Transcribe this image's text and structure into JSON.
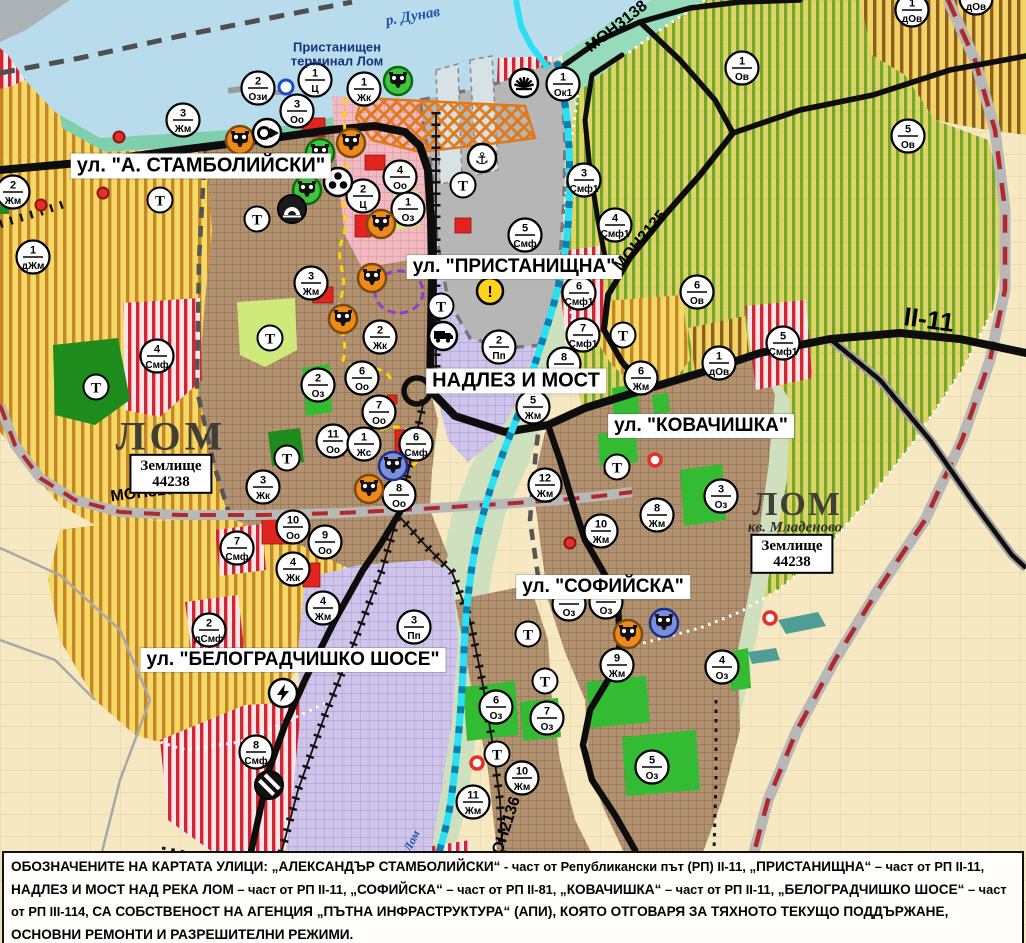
{
  "map": {
    "title": "Urban plan map of Lom (Лом), Bulgaria",
    "width": 1026,
    "height": 943
  },
  "colors": {
    "water": "#b9dcec",
    "river": "#2ae0f2",
    "river_dash": "#0b7fae",
    "shore": "#7fcfae",
    "urban": "#b29170",
    "agri": "#f5d964",
    "agri_stripe": "#c3862b",
    "olive": "#dfd468",
    "olive_stripe": "#74a82a",
    "smf_stripe": "#cf2633",
    "pink": "#f2b9c1",
    "lavender": "#cfc4e9",
    "beige": "#f6e8c1",
    "park_green": "#33bb33",
    "forest": "#1d8c1d",
    "road_black": "#0d0d0d",
    "road_red_dash": "#b02a2a",
    "label_blue": "#1f53b0",
    "port_orange": "#e0791c"
  },
  "street_labels": [
    {
      "text": "ул. \"А. СТАМБОЛИЙСКИ\"",
      "x": 201,
      "y": 166,
      "fs": 20
    },
    {
      "text": "ул. \"ПРИСТАНИЩНА\"",
      "x": 514,
      "y": 267,
      "fs": 19
    },
    {
      "text": "НАДЛЕЗ И МОСТ",
      "x": 516,
      "y": 381,
      "fs": 20
    },
    {
      "text": "ул. \"КОВАЧИШКА\"",
      "x": 701,
      "y": 426,
      "fs": 19
    },
    {
      "text": "ул. \"СОФИЙСКА\"",
      "x": 603,
      "y": 587,
      "fs": 19
    },
    {
      "text": "ул. \"БЕЛОГРАДЧИШКО ШОСЕ\"",
      "x": 293,
      "y": 660,
      "fs": 19
    }
  ],
  "place_labels": [
    {
      "text": "р. Дунав",
      "x": 413,
      "y": 17,
      "rot": -10,
      "fs": 15,
      "color": "#1f53b0",
      "serif": true,
      "italic": true
    },
    {
      "text": "Пристанищен",
      "x": 337,
      "y": 47,
      "rot": 0,
      "fs": 13,
      "color": "#15337a",
      "center": true
    },
    {
      "text": "терминал Лом",
      "x": 337,
      "y": 61,
      "rot": 0,
      "fs": 13,
      "color": "#15337a",
      "center": true
    },
    {
      "text": "ЛОМ",
      "x": 171,
      "y": 436,
      "rot": 0,
      "fs": 40,
      "color": "#3f3f38",
      "serif": true,
      "ls": 4
    },
    {
      "text": "ЛОМ",
      "x": 797,
      "y": 505,
      "rot": 0,
      "fs": 34,
      "color": "#3f3f38",
      "serif": true,
      "ls": 2
    },
    {
      "text": "кв. Младеново",
      "x": 795,
      "y": 528,
      "rot": 0,
      "fs": 15,
      "color": "#2e2e2e",
      "serif": true,
      "italic": true
    },
    {
      "text": "Лом",
      "x": 412,
      "y": 841,
      "rot": -63,
      "fs": 12,
      "color": "#1f53b0",
      "serif": true,
      "italic": true
    }
  ],
  "zemlishte_boxes": [
    {
      "line1": "Землище",
      "line2": "44238",
      "x": 171,
      "y": 474
    },
    {
      "line1": "Землище",
      "line2": "44238",
      "x": 792,
      "y": 554
    }
  ],
  "road_labels": [
    {
      "text": "МОН3139",
      "x": 147,
      "y": 493,
      "rot": -7,
      "fs": 16
    },
    {
      "text": "МОН3138",
      "x": 617,
      "y": 27,
      "rot": -38,
      "fs": 16
    },
    {
      "text": "МОН2135",
      "x": 641,
      "y": 241,
      "rot": -50,
      "fs": 16
    },
    {
      "text": "МОН2136",
      "x": 505,
      "y": 832,
      "rot": -72,
      "fs": 16
    },
    {
      "text": "II-11",
      "x": 929,
      "y": 320,
      "rot": 8,
      "fs": 26
    }
  ],
  "zone_markers": [
    {
      "n": "2",
      "c": "Ози",
      "x": 258,
      "y": 88
    },
    {
      "n": "1",
      "c": "Ц",
      "x": 315,
      "y": 80
    },
    {
      "n": "1",
      "c": "Жк",
      "x": 364,
      "y": 89
    },
    {
      "n": "3",
      "c": "Оо",
      "x": 297,
      "y": 111
    },
    {
      "n": "3",
      "c": "Жм",
      "x": 183,
      "y": 120
    },
    {
      "n": "2",
      "c": "Жм",
      "x": 13,
      "y": 192
    },
    {
      "n": "1",
      "c": "дЖм",
      "x": 33,
      "y": 257
    },
    {
      "n": "1",
      "c": "Ок1",
      "x": 563,
      "y": 84
    },
    {
      "n": "3",
      "c": "Смф1",
      "x": 584,
      "y": 180
    },
    {
      "n": "4",
      "c": "Смф1",
      "x": 615,
      "y": 225
    },
    {
      "n": "5",
      "c": "Смф",
      "x": 525,
      "y": 235
    },
    {
      "n": "4",
      "c": "Оо",
      "x": 400,
      "y": 177
    },
    {
      "n": "2",
      "c": "Ц",
      "x": 363,
      "y": 196
    },
    {
      "n": "1",
      "c": "Оз",
      "x": 408,
      "y": 209
    },
    {
      "n": "3",
      "c": "Жм",
      "x": 311,
      "y": 283
    },
    {
      "n": "4",
      "c": "Смф",
      "x": 157,
      "y": 356
    },
    {
      "n": "2",
      "c": "Оз",
      "x": 318,
      "y": 385
    },
    {
      "n": "2",
      "c": "Жк",
      "x": 380,
      "y": 337
    },
    {
      "n": "6",
      "c": "Оо",
      "x": 362,
      "y": 378
    },
    {
      "n": "7",
      "c": "Оо",
      "x": 379,
      "y": 412
    },
    {
      "n": "11",
      "c": "Оо",
      "x": 333,
      "y": 441
    },
    {
      "n": "1",
      "c": "Жс",
      "x": 364,
      "y": 444
    },
    {
      "n": "6",
      "c": "Смф",
      "x": 416,
      "y": 444
    },
    {
      "n": "8",
      "c": "Оо",
      "x": 399,
      "y": 495
    },
    {
      "n": "3",
      "c": "Жк",
      "x": 263,
      "y": 487
    },
    {
      "n": "10",
      "c": "Оо",
      "x": 293,
      "y": 527
    },
    {
      "n": "9",
      "c": "Оо",
      "x": 325,
      "y": 542
    },
    {
      "n": "7",
      "c": "Смф",
      "x": 237,
      "y": 548
    },
    {
      "n": "4",
      "c": "Жк",
      "x": 293,
      "y": 569
    },
    {
      "n": "4",
      "c": "Жм",
      "x": 323,
      "y": 608
    },
    {
      "n": "2",
      "c": "дСмф",
      "x": 209,
      "y": 630
    },
    {
      "n": "8",
      "c": "Смф",
      "x": 256,
      "y": 752
    },
    {
      "n": "2",
      "c": "Пп",
      "x": 499,
      "y": 347
    },
    {
      "n": "3",
      "c": "Пп",
      "x": 414,
      "y": 627
    },
    {
      "n": "6",
      "c": "Смф1",
      "x": 579,
      "y": 293
    },
    {
      "n": "7",
      "c": "Смф1",
      "x": 583,
      "y": 335
    },
    {
      "n": "8",
      "c": "",
      "x": 564,
      "y": 364
    },
    {
      "n": "5",
      "c": "Жм",
      "x": 533,
      "y": 407
    },
    {
      "n": "6",
      "c": "Жм",
      "x": 641,
      "y": 378
    },
    {
      "n": "12",
      "c": "Жм",
      "x": 545,
      "y": 485
    },
    {
      "n": "6",
      "c": "Ов",
      "x": 697,
      "y": 292
    },
    {
      "n": "1",
      "c": "дОв",
      "x": 719,
      "y": 363
    },
    {
      "n": "5",
      "c": "Смф1",
      "x": 783,
      "y": 343
    },
    {
      "n": "1",
      "c": "Ов",
      "x": 742,
      "y": 68
    },
    {
      "n": "5",
      "c": "Ов",
      "x": 908,
      "y": 136
    },
    {
      "n": "1",
      "c": "дОв",
      "x": 912,
      "y": 10
    },
    {
      "n": "1",
      "c": "дОв",
      "x": 976,
      "y": -2
    },
    {
      "n": "3",
      "c": "Оз",
      "x": 721,
      "y": 496
    },
    {
      "n": "8",
      "c": "Жм",
      "x": 657,
      "y": 515
    },
    {
      "n": "10",
      "c": "Жм",
      "x": 601,
      "y": 531
    },
    {
      "n": "",
      "c": "Оз",
      "x": 569,
      "y": 604
    },
    {
      "n": "",
      "c": "Оз",
      "x": 606,
      "y": 602
    },
    {
      "n": "9",
      "c": "Жм",
      "x": 617,
      "y": 665
    },
    {
      "n": "4",
      "c": "Оз",
      "x": 722,
      "y": 667
    },
    {
      "n": "5",
      "c": "Оз",
      "x": 652,
      "y": 767
    },
    {
      "n": "6",
      "c": "Оз",
      "x": 496,
      "y": 707
    },
    {
      "n": "7",
      "c": "Оз",
      "x": 547,
      "y": 718
    },
    {
      "n": "10",
      "c": "Жм",
      "x": 522,
      "y": 778
    },
    {
      "n": "11",
      "c": "Жм",
      "x": 473,
      "y": 802
    }
  ],
  "t_markers": [
    {
      "x": 160,
      "y": 200
    },
    {
      "x": 257,
      "y": 219
    },
    {
      "x": 463,
      "y": 185
    },
    {
      "x": 441,
      "y": 306
    },
    {
      "x": 270,
      "y": 338
    },
    {
      "x": 96,
      "y": 387
    },
    {
      "x": 287,
      "y": 458
    },
    {
      "x": 623,
      "y": 335
    },
    {
      "x": 617,
      "y": 467
    },
    {
      "x": 528,
      "y": 634
    },
    {
      "x": 545,
      "y": 681
    },
    {
      "x": 497,
      "y": 754
    }
  ],
  "icon_markers": [
    {
      "type": "culture-orange",
      "x": 240,
      "y": 140
    },
    {
      "type": "culture-orange",
      "x": 351,
      "y": 143
    },
    {
      "type": "culture-orange",
      "x": 381,
      "y": 224
    },
    {
      "type": "culture-orange",
      "x": 372,
      "y": 278
    },
    {
      "type": "culture-orange",
      "x": 343,
      "y": 319
    },
    {
      "type": "culture-orange",
      "x": 369,
      "y": 489
    },
    {
      "type": "culture-orange",
      "x": 628,
      "y": 634
    },
    {
      "type": "culture-green",
      "x": 398,
      "y": 81
    },
    {
      "type": "culture-green",
      "x": 320,
      "y": 153
    },
    {
      "type": "culture-green",
      "x": 307,
      "y": 190
    },
    {
      "type": "culture-blue",
      "x": 393,
      "y": 466
    },
    {
      "type": "culture-blue",
      "x": 664,
      "y": 623
    },
    {
      "type": "monument",
      "x": 267,
      "y": 133
    },
    {
      "type": "trefoil",
      "x": 338,
      "y": 182
    },
    {
      "type": "tunnel",
      "x": 292,
      "y": 209
    },
    {
      "type": "anchor",
      "x": 482,
      "y": 158
    },
    {
      "type": "crane",
      "x": 524,
      "y": 83
    },
    {
      "type": "warning",
      "x": 490,
      "y": 291
    },
    {
      "type": "truck",
      "x": 443,
      "y": 336
    },
    {
      "type": "lightning",
      "x": 283,
      "y": 693
    },
    {
      "type": "crossing",
      "x": 269,
      "y": 785
    }
  ],
  "point_markers": [
    {
      "kind": "red-dot",
      "x": 119,
      "y": 137
    },
    {
      "kind": "red-dot",
      "x": 103,
      "y": 193
    },
    {
      "kind": "red-dot",
      "x": 41,
      "y": 205
    },
    {
      "kind": "red-dot",
      "x": 570,
      "y": 543
    },
    {
      "kind": "red-ring",
      "x": 655,
      "y": 460
    },
    {
      "kind": "red-ring",
      "x": 770,
      "y": 618
    },
    {
      "kind": "red-ring",
      "x": 477,
      "y": 763
    },
    {
      "kind": "blue-ring",
      "x": 286,
      "y": 87
    }
  ],
  "note": {
    "segments": [
      {
        "t": "ОБОЗНАЧЕНИТЕ НА КАРТАТА УЛИЦИ: „АЛЕКСАНДЪР СТАМБОЛИЙСКИ“",
        "h": true
      },
      {
        "t": " - част от Републикански път (РП) II-11, ",
        "h": false
      },
      {
        "t": "„ПРИСТАНИЩНА“",
        "h": true
      },
      {
        "t": " – част от РП II-11, ",
        "h": false
      },
      {
        "t": "НАДЛЕЗ И МОСТ НАД РЕКА ЛОМ",
        "h": true
      },
      {
        "t": " – част от РП II-11, ",
        "h": false
      },
      {
        "t": "„СОФИЙСКА“",
        "h": true
      },
      {
        "t": " – част от РП II-81, ",
        "h": false
      },
      {
        "t": "„КОВАЧИШКА“",
        "h": true
      },
      {
        "t": " – част от РП II-11, ",
        "h": false
      },
      {
        "t": "„БЕЛОГРАДЧИШКО ШОСЕ“",
        "h": true
      },
      {
        "t": " – част от РП III-114, ",
        "h": false
      },
      {
        "t": "СА СОБСТВЕНОСТ НА АГЕНЦИЯ „ПЪТНА ИНФРАСТРУКТУРА“ (АПИ), КОЯТО ОТГОВАРЯ ЗА ТЯХНОТО ТЕКУЩО ПОДДЪРЖАНЕ, ОСНОВНИ РЕМОНТИ И РАЗРЕШИТЕЛНИ РЕЖИМИ.",
        "h": true
      }
    ]
  }
}
